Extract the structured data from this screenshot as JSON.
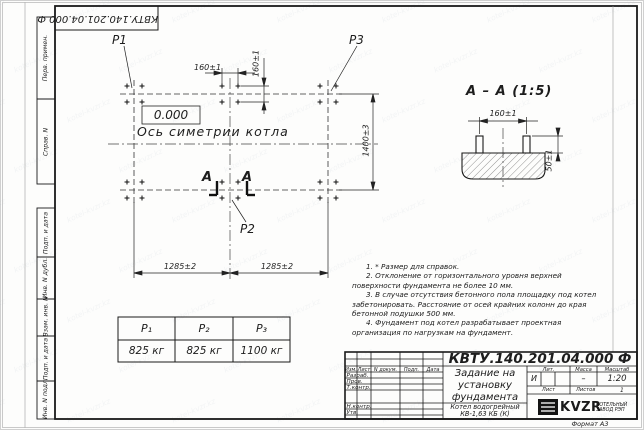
{
  "sheet": {
    "stamp_top": "КВТУ.140.201.04.000 Ф",
    "format_label": "Формат А3",
    "watermark": "kotel-kvzr.kz",
    "sidebar": [
      "Перв. примен.",
      "Справ. N",
      "Подп. и дата",
      "Инв. N дубл.",
      "Взам. инв. N",
      "Подп. и дата",
      "Инв. N подл."
    ]
  },
  "plan": {
    "elevation": "0.000",
    "axis_label": "Ось симетрии котла",
    "point_labels": {
      "p1": "P1",
      "p2": "P2",
      "p3": "P3"
    },
    "dims": {
      "bolt_spacing_x": "160±1",
      "bolt_spacing_y": "160±1",
      "width": "1400±3",
      "length_left": "1285±2",
      "length_right": "1285±2"
    },
    "cut_letter_left": "А",
    "cut_letter_right": "А"
  },
  "section": {
    "title": "А – А (1:5)",
    "dims": {
      "bolt_spacing": "160±1",
      "protrusion": "50±1"
    }
  },
  "notes": [
    "1. * Размер для справок.",
    "2. Отклонение от горизонтального уровня верхней поверхности фундамента не более 10 мм.",
    "3. В случае отсутствия бетонного пола площадку под котел забетонировать. Расстояние от осей крайних колонн до края бетонной подушки 500 мм.",
    "4. Фундамент под котел разрабатывает проектная организация по нагрузкам на фундамент."
  ],
  "load_table": {
    "headers": [
      "P₁",
      "P₂",
      "P₃"
    ],
    "values": [
      "825 кг",
      "825 кг",
      "1100 кг"
    ]
  },
  "title_block": {
    "doc_number": "КВТУ.140.201.04.000 Ф",
    "columns": [
      "Изм.",
      "Лист",
      "N докум.",
      "Подп.",
      "Дата"
    ],
    "rows": [
      "Разраб.",
      "Пров.",
      "Т.контр.",
      "Н.контр.",
      "Утв."
    ],
    "title_lines": [
      "Задание на",
      "установку",
      "фундамента"
    ],
    "product_lines": [
      "Котел водогрейный",
      "КВ-1,63 КБ (К)"
    ],
    "lit_header": "Лит.",
    "mass_header": "Масса",
    "scale_header": "Масштаб",
    "lit": "И",
    "mass": "–",
    "scale": "1:20",
    "sheet_header": "Лист",
    "sheets_header": "Листов",
    "sheets_count": "1",
    "company": "KVZR",
    "company_sub_lines": [
      "КОТЕЛЬНЫЙ",
      "ЗАВОД РЭП"
    ]
  }
}
